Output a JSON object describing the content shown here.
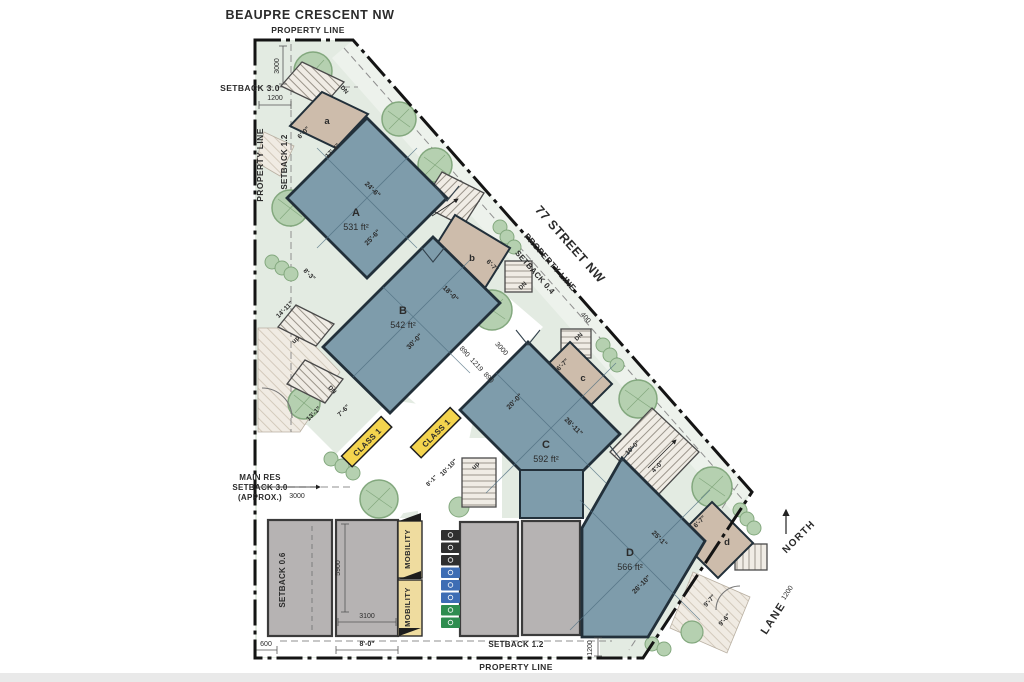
{
  "title": {
    "street_top": "BEAUPRE CRESCENT NW",
    "street_right": "77 STREET NW",
    "lane": "LANE",
    "north": "NORTH"
  },
  "boundary": {
    "property_line": "PROPERTY LINE",
    "setback_30": "SETBACK 3.0",
    "setback_12": "SETBACK 1.2",
    "setback_04": "SETBACK 0.4",
    "setback_06": "SETBACK 0.6",
    "main_res_1": "MAIN RES",
    "main_res_2": "SETBACK 3.0",
    "main_res_3": "(APPROX.)"
  },
  "units": {
    "A": {
      "label": "A",
      "area": "531 ft²",
      "dim_w": "24'-6\"",
      "dim_h": "25'-6\""
    },
    "B": {
      "label": "B",
      "area": "542 ft²",
      "dim_w": "18'-0\"",
      "dim_h": "30'-0\""
    },
    "C": {
      "label": "C",
      "area": "592 ft²",
      "dim_w": "20'-0\"",
      "dim_h": "26'-11\""
    },
    "D": {
      "label": "D",
      "area": "566 ft²",
      "dim_w": "25'-1\"",
      "dim_h": "26'-10\""
    }
  },
  "entrances": {
    "a": {
      "label": "a",
      "dim": "6'-0\"",
      "dim2": "17'-4\""
    },
    "b": {
      "label": "b",
      "dim": "6'-7\""
    },
    "c": {
      "label": "c",
      "dim": "6'-7\""
    },
    "d": {
      "label": "d",
      "dim": "6'-7\""
    }
  },
  "stairs": {
    "up": "up",
    "dn": "DN"
  },
  "badges": {
    "class1": "CLASS 1",
    "mobility": "MOBILITY"
  },
  "dims": {
    "d3000": "3000",
    "d1200": "1200",
    "d890": "890",
    "d1219": "1219",
    "d400": "400",
    "d600": "600",
    "d3100": "3100",
    "d5900": "5900",
    "d8_0": "8'-0\"",
    "d14_11": "14'-11\"",
    "d8_3": "8'-3\"",
    "d13_1": "13'-1\"",
    "d7_6": "7'-6\"",
    "d10_10": "10'-10\"",
    "d8_1": "8'-1\"",
    "d10_0": "10'-0\"",
    "d4_0": "4'-0\"",
    "d9_7": "9'-7\"",
    "d9_6": "9'-6\""
  },
  "colors": {
    "site": "#e3ebe2",
    "building": "#7e9cab",
    "entrance": "#cdbcab",
    "tree": "#b5d0b0",
    "parking": "#b6b3b3",
    "mobility": "#efdc9f",
    "class1": "#f4d44e",
    "bin_garbage": "#2f2f2f",
    "bin_recycle": "#3e6db4",
    "bin_organics": "#2e8d4f",
    "wall": "#22303a",
    "property_line": "#141414"
  }
}
